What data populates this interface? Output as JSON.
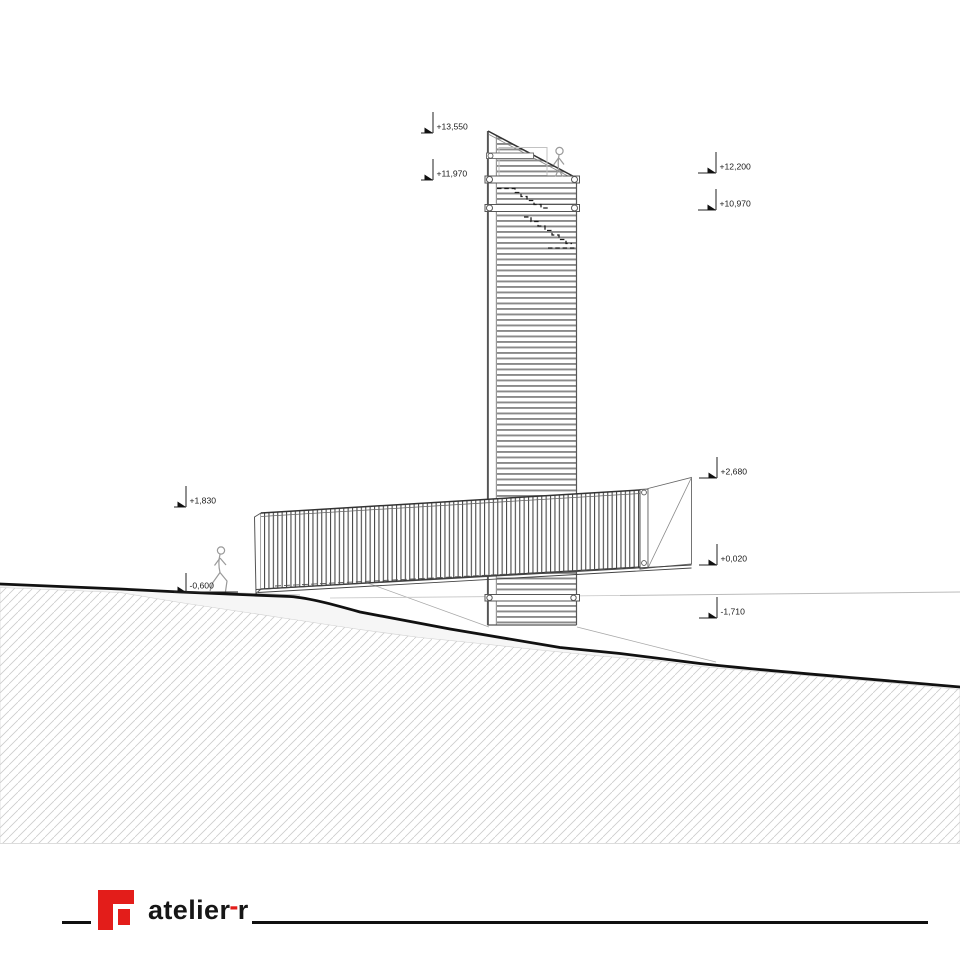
{
  "markers": [
    {
      "label": "+13,550"
    },
    {
      "label": "+11,970"
    },
    {
      "label": "+12,200"
    },
    {
      "label": "+10,970"
    },
    {
      "label": "+2,680"
    },
    {
      "label": "+0,020"
    },
    {
      "label": "-1,710"
    },
    {
      "label": "+1,830"
    },
    {
      "label": "-0,600"
    }
  ],
  "footer": {
    "brand": "atelier",
    "hyphen": "-",
    "suffix": "r"
  },
  "colors": {
    "accent_red": "#e31d1a",
    "line_dark": "#111111",
    "hatch_gray": "#cccccc",
    "louver_gray": "#8a8a8a"
  }
}
